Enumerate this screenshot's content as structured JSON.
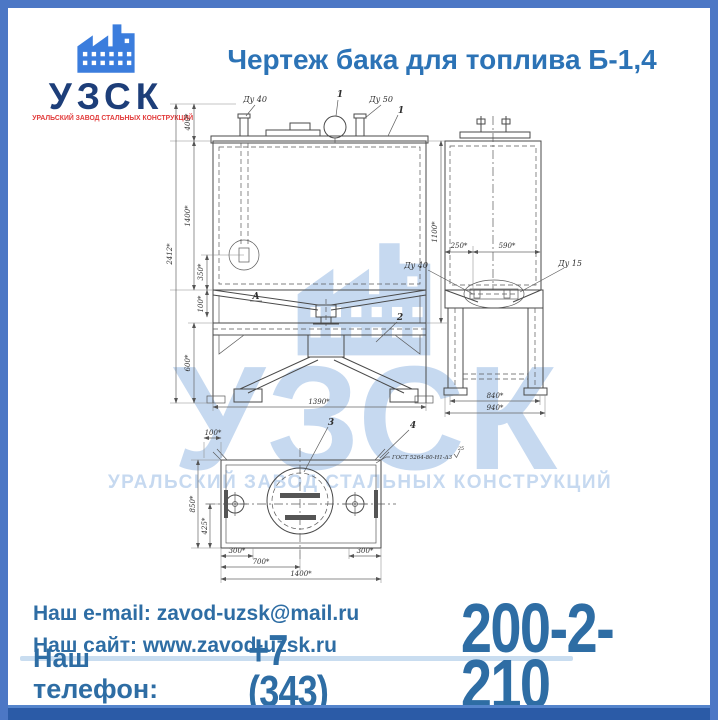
{
  "page": {
    "title": "Чертеж бака для топлива Б-1,4"
  },
  "logo": {
    "abbr": "УЗСК",
    "tagline": "УРАЛЬСКИЙ ЗАВОД СТАЛЬНЫХ КОНСТРУКЦИЙ"
  },
  "watermark": {
    "abbr": "УЗСК",
    "tagline": "УРАЛЬСКИЙ ЗАВОД СТАЛЬНЫХ КОНСТРУКЦИЙ"
  },
  "drawing": {
    "front_view": {
      "fitting_left": "Ду 40",
      "fitting_right": "Ду 50",
      "callout_vent": "1",
      "callout_corner": "1",
      "callout_support": "2",
      "view_arrow": "А",
      "dim_top_offset": "400*",
      "dim_tank_height": "1400*",
      "dim_total_height": "2412*",
      "dim_detail_offset": "350*",
      "dim_slope": "100*",
      "dim_leg_height": "600*",
      "dim_right_height": "1100*",
      "dim_width": "1390*"
    },
    "side_view": {
      "dim_left": "250*",
      "dim_right": "590*",
      "label_drain": "Ду 40",
      "label_valve": "Ду 15",
      "dim_width_inner": "840*",
      "dim_width_outer": "940*"
    },
    "plan_view": {
      "callout_manhole": "3",
      "callout_corner": "4",
      "dim_notch": "100*",
      "dim_depth": "850*",
      "dim_half_depth": "425*",
      "dim_left_offset": "300*",
      "dim_right_offset": "300*",
      "dim_center": "700*",
      "dim_width": "1400*",
      "weld_note": "ГОСТ 5264-80-Н1-Δ3",
      "weld_size": "25"
    }
  },
  "footer": {
    "email_line": "Наш e-mail: zavod-uzsk@mail.ru",
    "site_line": "Наш сайт: www.zavod-uzsk.ru",
    "phone_label": "Наш телефон:",
    "phone_code": "+7 (343)",
    "phone_number": "200-2-210"
  },
  "colors": {
    "frame": "#4c77c5",
    "frame_bottom": "#2b5ba7",
    "title": "#2c73b6",
    "logo_navy": "#1d3e79",
    "logo_red": "#e23b3b",
    "logo_blue": "#3b7ddd",
    "footer_text": "#2e6da4",
    "watermark": "#c6d9f0",
    "line": "#4a4a4a"
  }
}
